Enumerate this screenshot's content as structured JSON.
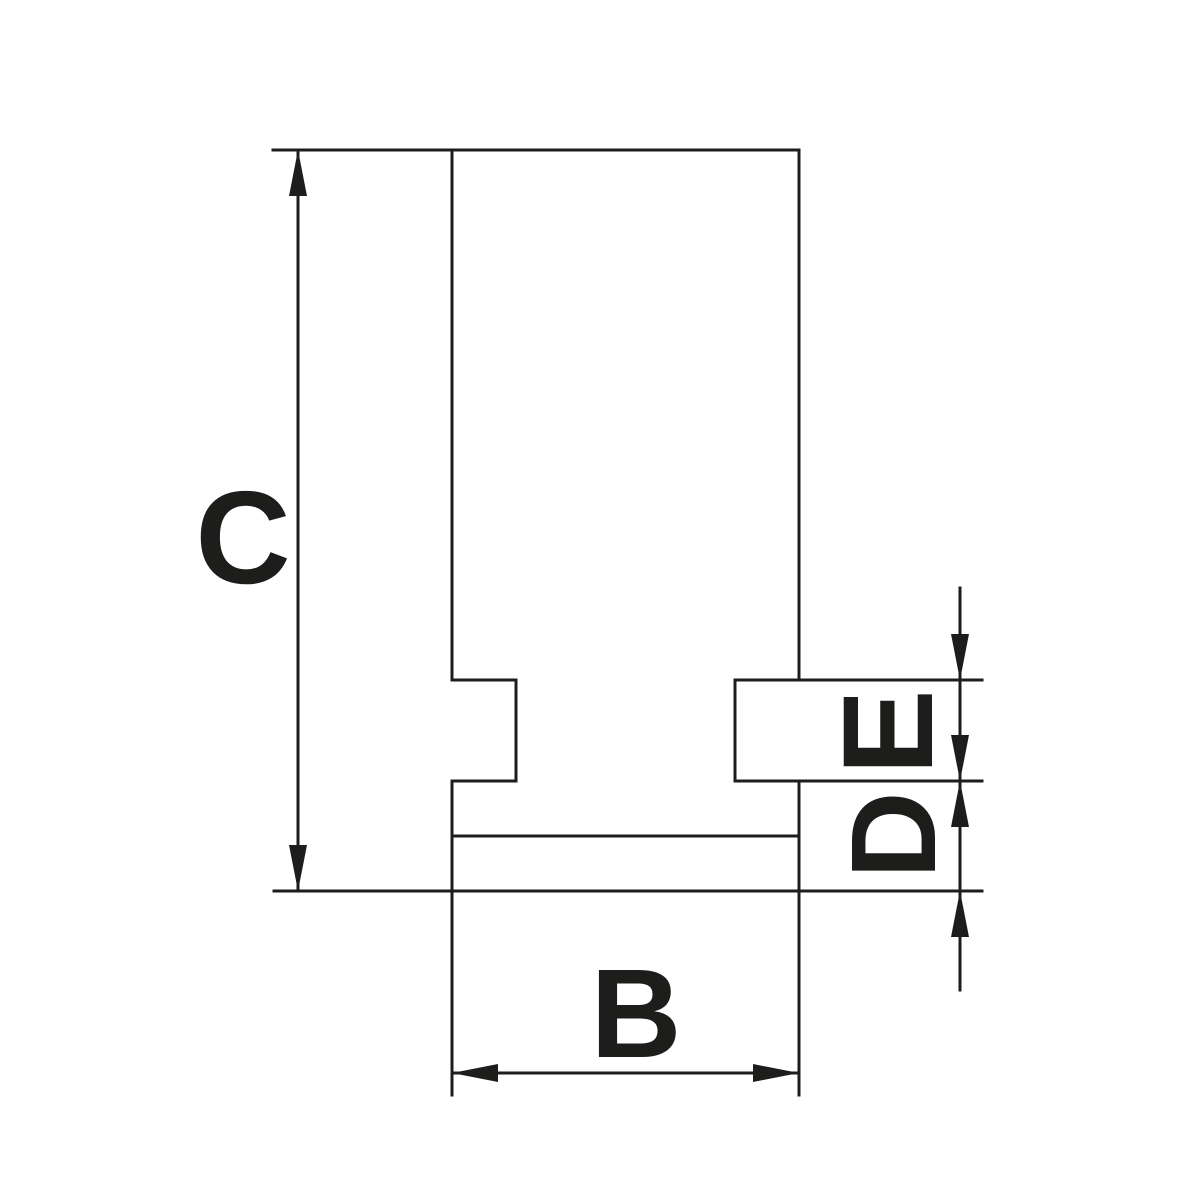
{
  "page": {
    "background_color": "#ffffff",
    "description_labels": [
      "B",
      "C",
      "D",
      "E"
    ]
  },
  "drawing": {
    "canvas": {
      "width": 1200,
      "height": 1200
    },
    "stroke": {
      "color": "#1d1d1b",
      "width": 3
    },
    "arrow": {
      "length": 46,
      "halfWidth": 9
    },
    "labels": [
      {
        "id": "dim-label-c",
        "text": "C",
        "cx": 243,
        "cy": 535,
        "rotate": 0,
        "fontSize": 132
      },
      {
        "id": "dim-label-b",
        "text": "B",
        "cx": 636,
        "cy": 1012,
        "rotate": 0,
        "fontSize": 126
      },
      {
        "id": "dim-label-e",
        "text": "E",
        "cx": 886,
        "cy": 732,
        "rotate": -90,
        "fontSize": 128
      },
      {
        "id": "dim-label-d",
        "text": "D",
        "cx": 891,
        "cy": 835,
        "rotate": -90,
        "fontSize": 121
      }
    ],
    "segments": [
      {
        "name": "body-top-edge-and-c-extension",
        "x1": 273,
        "y1": 150,
        "x2": 799,
        "y2": 150
      },
      {
        "name": "body-bottom-edge-and-extensions",
        "x1": 274,
        "y1": 891,
        "x2": 982,
        "y2": 891
      },
      {
        "name": "body-left-edge-upper",
        "x1": 452,
        "y1": 150,
        "x2": 452,
        "y2": 680
      },
      {
        "name": "left-groove-top",
        "x1": 452,
        "y1": 680,
        "x2": 516,
        "y2": 680
      },
      {
        "name": "left-groove-right-wall",
        "x1": 516,
        "y1": 680,
        "x2": 516,
        "y2": 781
      },
      {
        "name": "left-groove-bottom",
        "x1": 452,
        "y1": 781,
        "x2": 516,
        "y2": 781
      },
      {
        "name": "body-left-edge-lower-and-b-extension",
        "x1": 452,
        "y1": 781,
        "x2": 452,
        "y2": 1095
      },
      {
        "name": "body-right-edge-upper",
        "x1": 799,
        "y1": 150,
        "x2": 799,
        "y2": 680
      },
      {
        "name": "body-right-edge-lower-and-b-extension",
        "x1": 799,
        "y1": 781,
        "x2": 799,
        "y2": 1095
      },
      {
        "name": "tongue-left-edge",
        "x1": 735,
        "y1": 680,
        "x2": 735,
        "y2": 781
      },
      {
        "name": "tongue-top-and-e-extension",
        "x1": 735,
        "y1": 680,
        "x2": 982,
        "y2": 680
      },
      {
        "name": "tongue-bottom-and-de-extension",
        "x1": 735,
        "y1": 781,
        "x2": 982,
        "y2": 781
      },
      {
        "name": "inner-step-line",
        "x1": 452,
        "y1": 836,
        "x2": 799,
        "y2": 836
      },
      {
        "name": "c-dimension-line",
        "x1": 298,
        "y1": 150,
        "x2": 298,
        "y2": 891
      },
      {
        "name": "b-dimension-line",
        "x1": 452,
        "y1": 1073,
        "x2": 799,
        "y2": 1073
      },
      {
        "name": "de-dimension-line",
        "x1": 960,
        "y1": 588,
        "x2": 960,
        "y2": 990
      }
    ],
    "arrowheads": [
      {
        "name": "c-arrow-top",
        "x": 298,
        "y": 150,
        "dir": "up"
      },
      {
        "name": "c-arrow-bottom",
        "x": 298,
        "y": 891,
        "dir": "down"
      },
      {
        "name": "b-arrow-left",
        "x": 452,
        "y": 1073,
        "dir": "left"
      },
      {
        "name": "b-arrow-right",
        "x": 799,
        "y": 1073,
        "dir": "right"
      },
      {
        "name": "e-arrow-top",
        "x": 960,
        "y": 680,
        "dir": "down"
      },
      {
        "name": "d-arrow-top",
        "x": 960,
        "y": 781,
        "dir": "down"
      },
      {
        "name": "e-arrow-bottom",
        "x": 960,
        "y": 781,
        "dir": "up"
      },
      {
        "name": "d-arrow-bottom",
        "x": 960,
        "y": 891,
        "dir": "up"
      }
    ]
  }
}
